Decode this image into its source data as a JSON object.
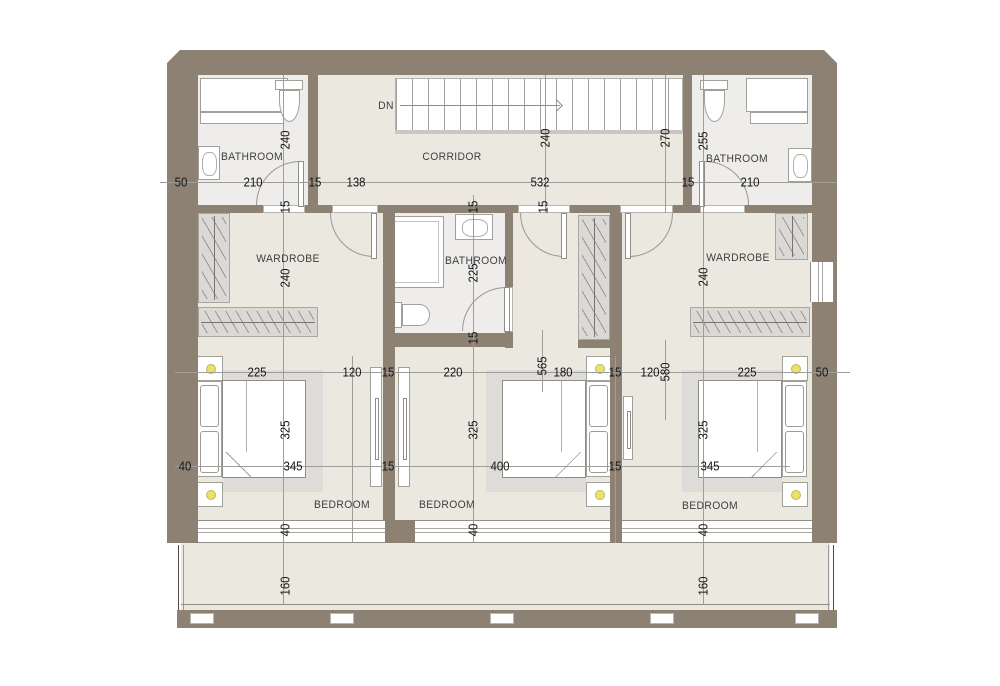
{
  "title": "Upper floor plan with three bedrooms, three bathrooms, wardrobes, corridor and balcony",
  "colors": {
    "wall": "#8d8173",
    "floor": "#ebe8e0",
    "bathroom_floor": "#eeedeb",
    "hanger_strip": "#dad9d5",
    "bed_shadow": "#dedcd8",
    "lamp": "#e9e464",
    "dimension_line": "#9e9d99",
    "dimension_text": "#161616"
  },
  "rooms": {
    "bathroom_left": "BATHROOM",
    "corridor": "CORRIDOR",
    "bathroom_right": "BATHROOM",
    "wardrobe_left": "WARDROBE",
    "bathroom_middle": "BATHROOM",
    "wardrobe_right": "WARDROBE",
    "bedroom_left": "BEDROOM",
    "bedroom_middle": "BEDROOM",
    "bedroom_right": "BEDROOM",
    "stairs_direction": "DN"
  },
  "dims": {
    "r1": {
      "a": "50",
      "b": "210",
      "c": "15",
      "d": "138",
      "e": "532",
      "f": "15",
      "g": "210"
    },
    "r2": {
      "a": "225",
      "b": "120",
      "c": "15",
      "d": "220",
      "e": "180",
      "f": "15",
      "g": "120",
      "h": "225",
      "i": "50"
    },
    "r3": {
      "a": "40",
      "b": "345",
      "c": "15",
      "d": "400",
      "e": "15",
      "f": "345"
    },
    "v": {
      "a": "240",
      "b": "15",
      "c": "240",
      "d": "15",
      "e": "270",
      "f": "255",
      "g": "240",
      "h": "15",
      "i": "225",
      "j": "15",
      "k": "240",
      "l": "325",
      "m": "325",
      "n": "325",
      "o": "565",
      "p": "580",
      "q": "40",
      "r": "40",
      "s": "40",
      "t": "160",
      "u": "160"
    }
  }
}
